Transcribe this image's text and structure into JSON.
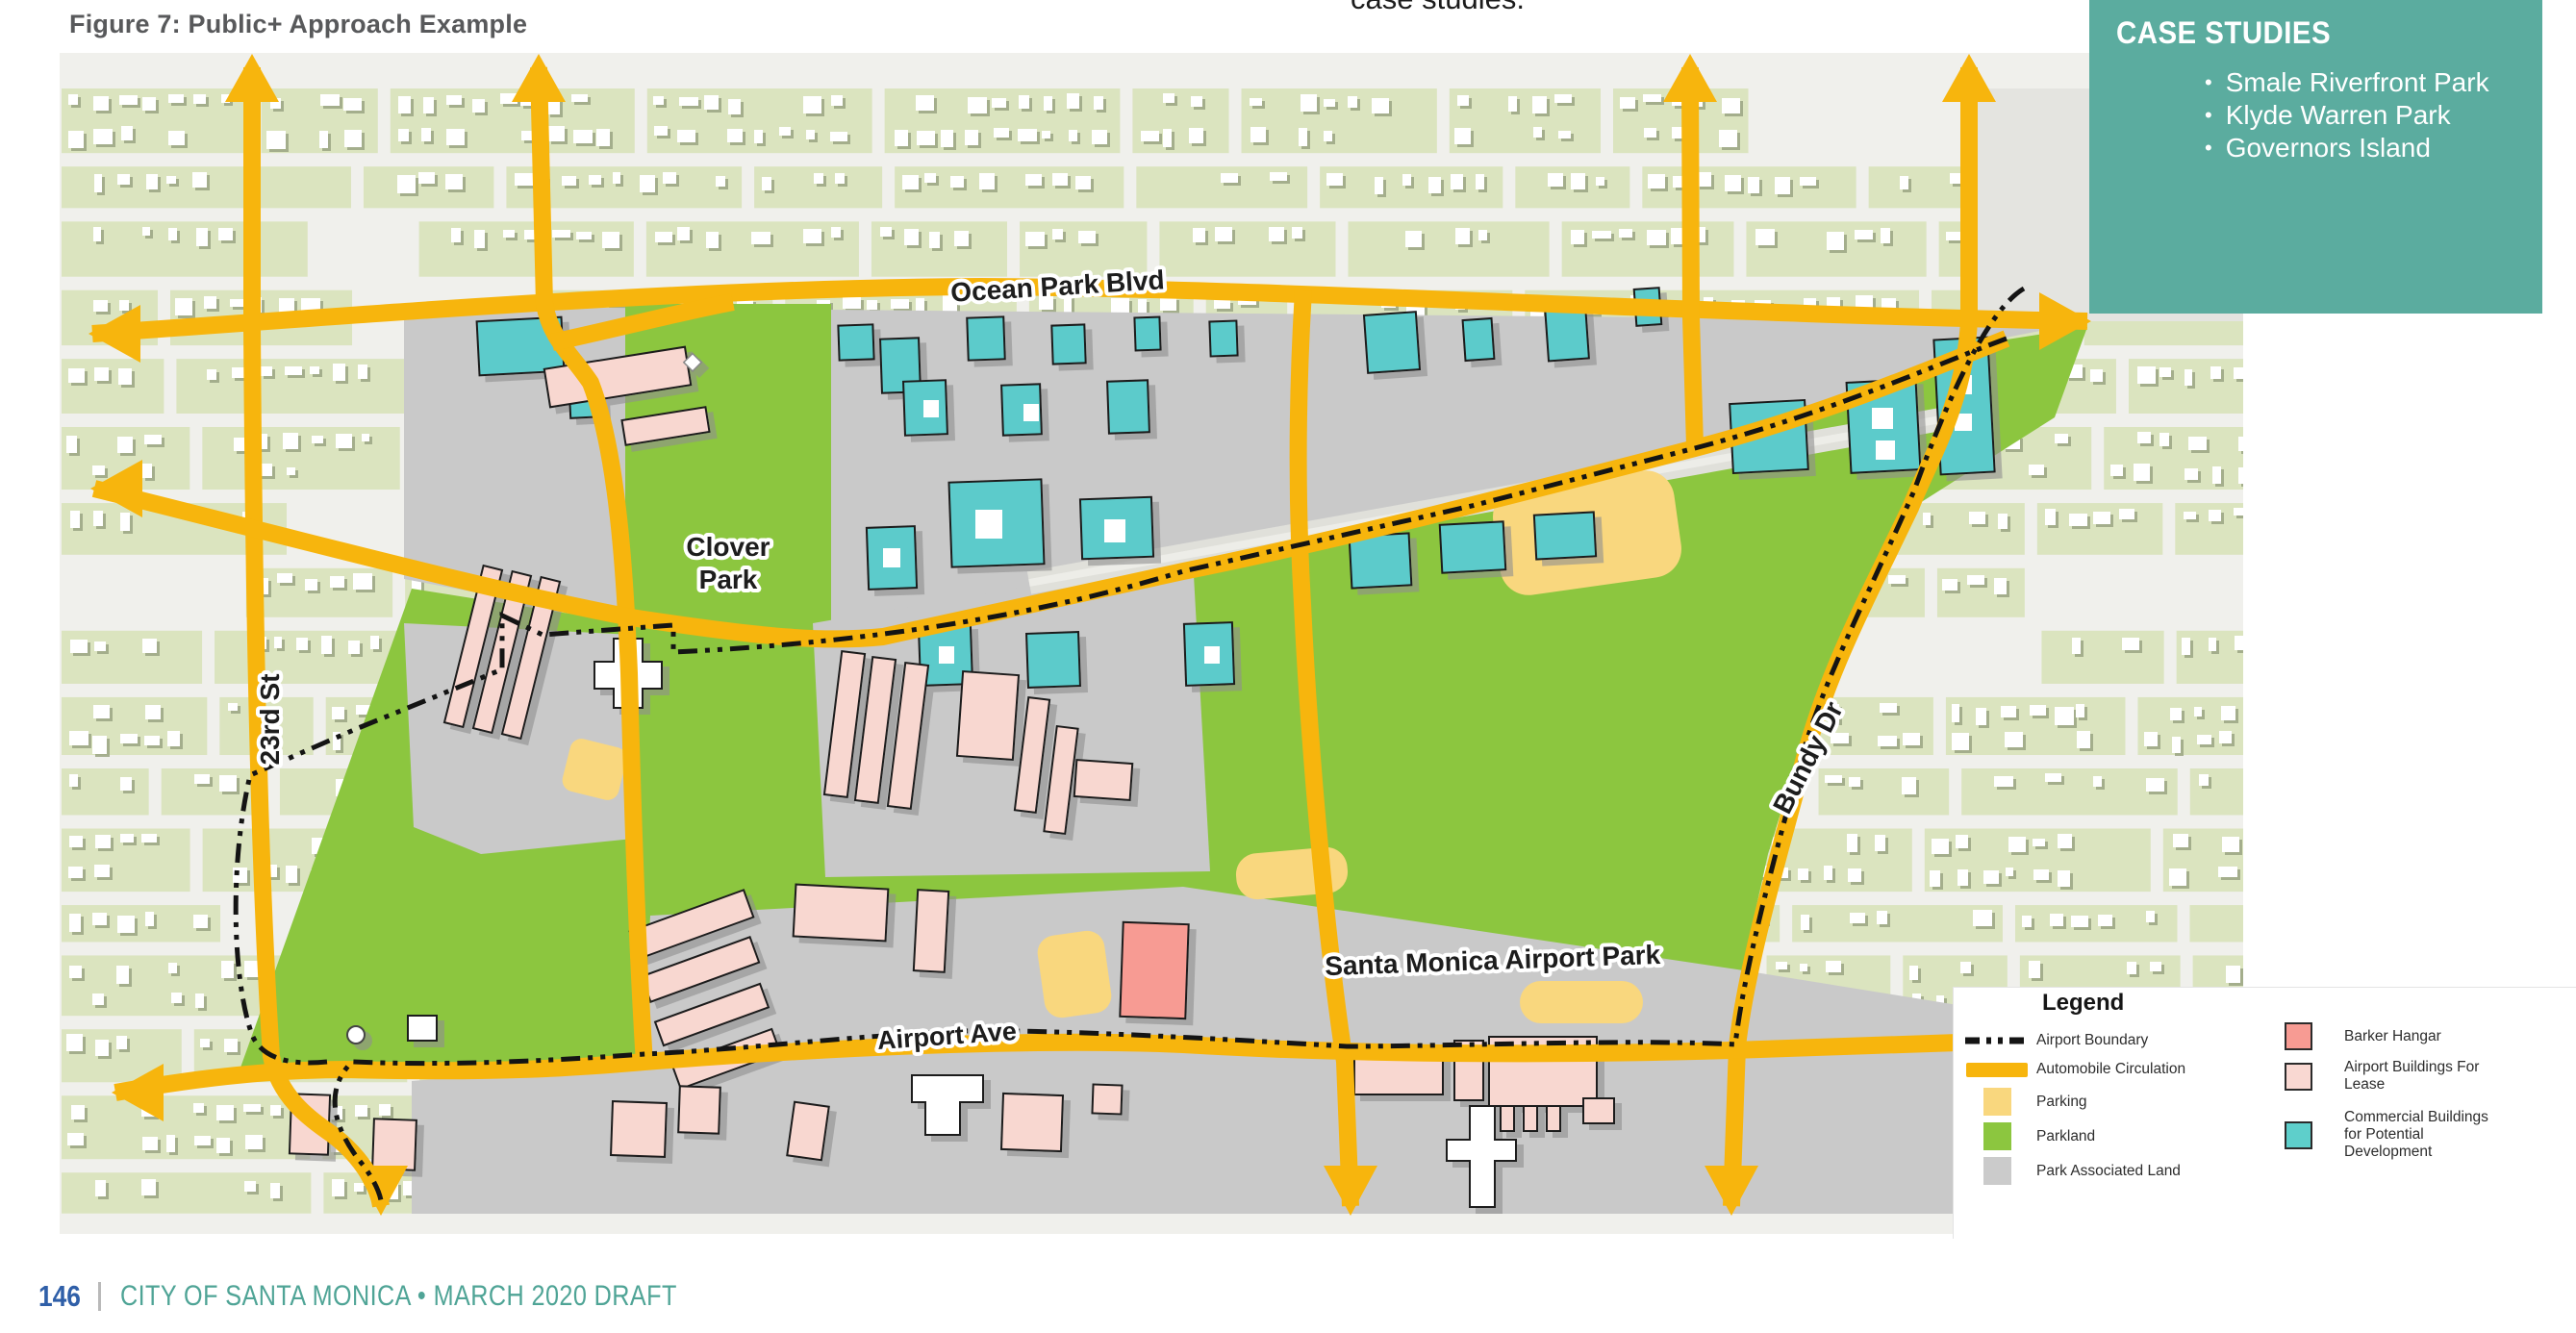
{
  "page": {
    "figure_title": "Figure 7: Public+ Approach Example",
    "top_partial_text": "case studies.",
    "footer": {
      "page_number": "146",
      "text": "CITY OF SANTA MONICA • MARCH 2020 DRAFT"
    }
  },
  "case_studies_panel": {
    "title": "CASE STUDIES",
    "items": [
      "Smale Riverfront Park",
      "Klyde Warren Park",
      "Governors Island"
    ],
    "background": "#5BAC9F"
  },
  "map": {
    "street_labels": {
      "ocean_park_blvd": "Ocean Park Blvd",
      "twenty_third_st": "23rd St",
      "bundy_dr": "Bundy Dr",
      "airport_ave": "Airport Ave"
    },
    "area_labels": {
      "clover_park_lines": [
        "Clover",
        "Park"
      ],
      "sm_airport_park": "Santa Monica Airport Park"
    }
  },
  "legend": {
    "title": "Legend",
    "items": [
      {
        "label": "Airport Boundary",
        "icon": "dash-dot-line",
        "color": "#141414"
      },
      {
        "label": "Automobile Circulation",
        "icon": "bar",
        "color": "#F7B50D"
      },
      {
        "label": "Parking",
        "icon": "swatch",
        "color": "#F9D77E"
      },
      {
        "label": "Parkland",
        "icon": "swatch",
        "color": "#8CC63F"
      },
      {
        "label": "Park Associated Land",
        "icon": "swatch",
        "color": "#CBCBCB"
      },
      {
        "label": "Barker Hangar",
        "icon": "swatch-outlined",
        "color": "#F79B93"
      },
      {
        "label": "Airport Buildings For Lease",
        "icon": "swatch-outlined",
        "color": "#F9D8D2"
      },
      {
        "label": "Commercial Buildings for Potential Development",
        "icon": "swatch-outlined",
        "color": "#5ECFCB"
      }
    ]
  },
  "colors": {
    "road": "#F7B50D",
    "parkland": "#8CC63F",
    "parking": "#F9D77E",
    "park_associated": "#C9C9C9",
    "commercial_teal": "#5BCBCB",
    "airport_pink": "#F8D7D0",
    "barker_salmon": "#F79B93",
    "panel_teal": "#5BAC9F",
    "footer_blue": "#2F5FA8",
    "footer_teal": "#4FA496",
    "residential_green": "#DBE4BF",
    "boundary": "#141414"
  }
}
